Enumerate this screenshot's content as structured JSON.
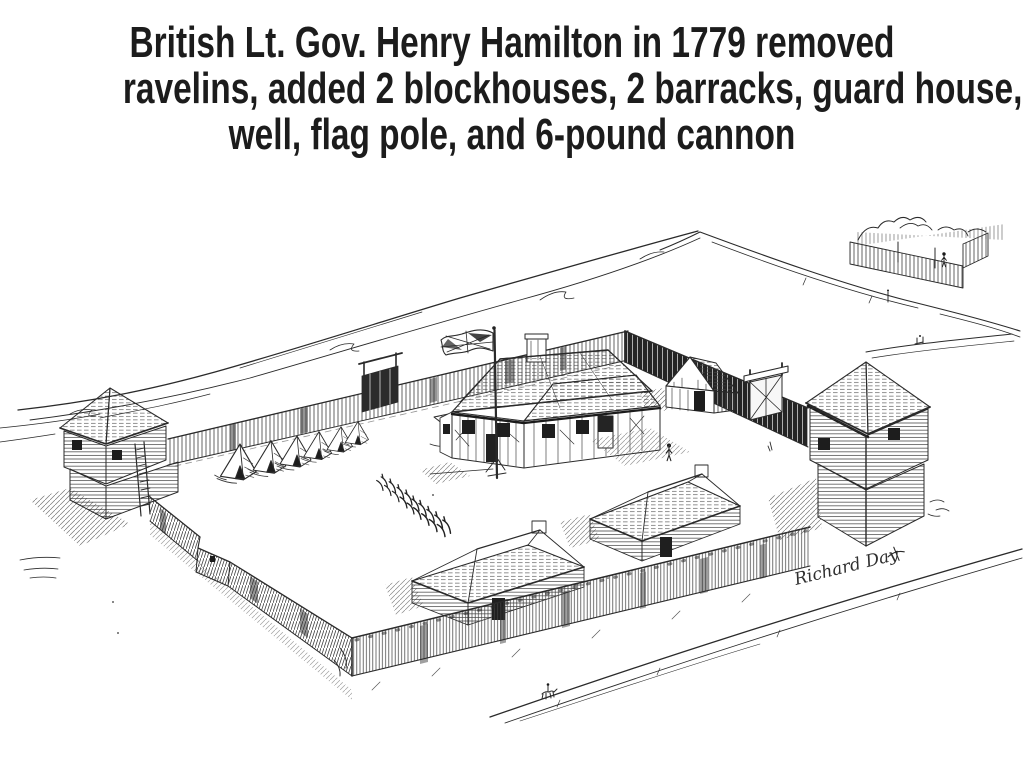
{
  "slide": {
    "title_lines": [
      "British Lt. Gov. Henry Hamilton in 1779 removed",
      "ravelins, added 2 blockhouses, 2 barracks, guard house,",
      "well, flag pole, and 6-pound cannon"
    ],
    "title_color": "#1c1c1c",
    "background_color": "#ffffff"
  },
  "illustration": {
    "medium": "pen-and-ink drawing",
    "subject": "palisaded fort seen from above with blockhouses, barracks, tents and flag",
    "ink_color": "#2a2a2a",
    "paper_color": "#ffffff",
    "signature": "Richard Day",
    "elements": [
      "river-bank",
      "upper-road",
      "orchard",
      "left-blockhouse",
      "right-blockhouse",
      "palisade-walls",
      "north-gate",
      "main-gate",
      "guard-house",
      "commandants-house",
      "flag-pole",
      "union-jack-flag",
      "well",
      "tent-row",
      "stacked-arms-row",
      "barracks",
      "courtyard-figure",
      "horse-rider",
      "lower-road"
    ]
  }
}
